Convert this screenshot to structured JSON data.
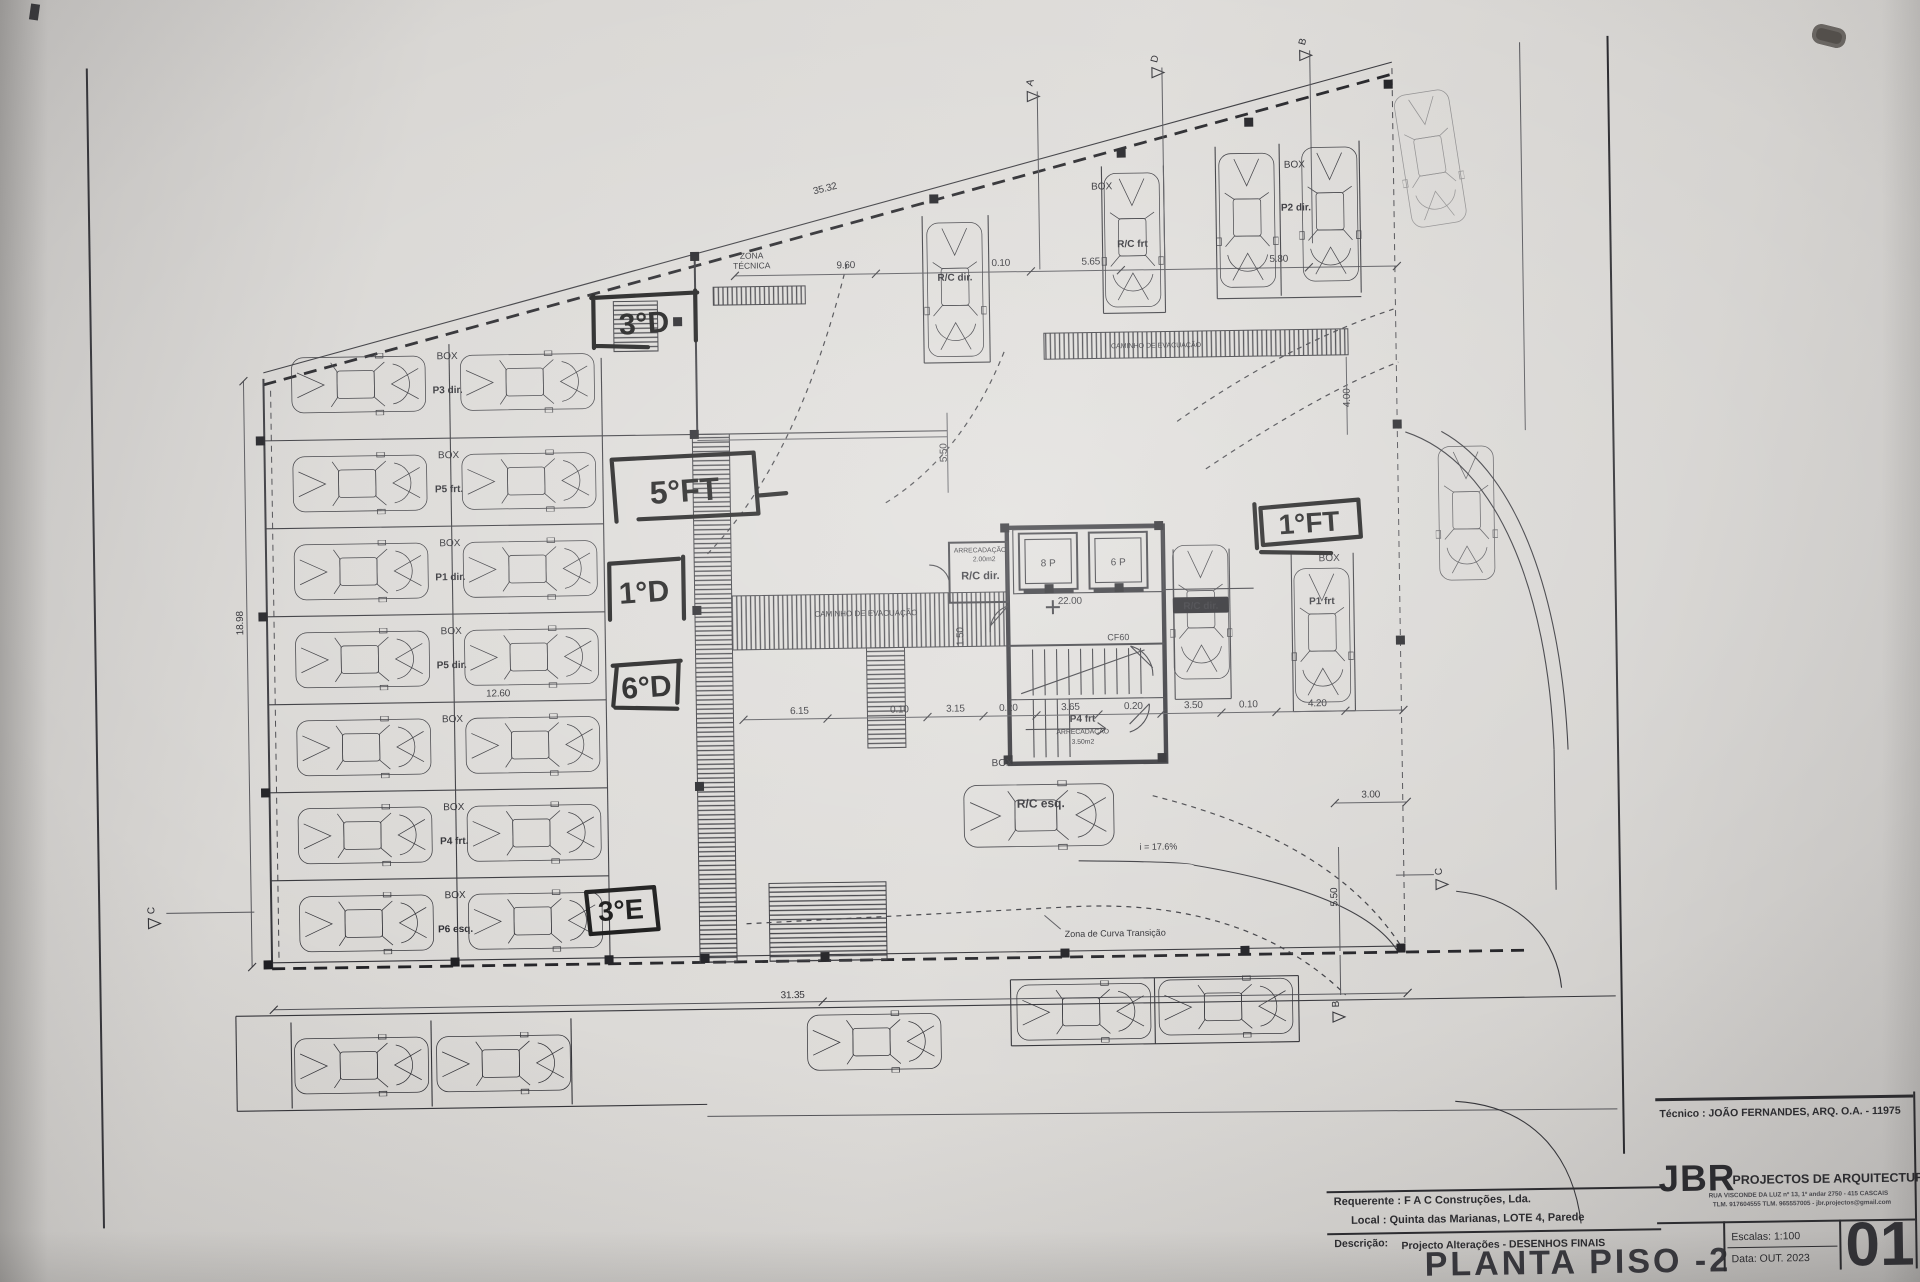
{
  "title_block": {
    "tecnico": "Técnico : JOÃO FERNANDES, ARQ.   O.A. - 11975",
    "firm": "JBR",
    "firm_tagline": "PROJECTOS DE ARQUITECTURA",
    "firm_address": "RUA VISCONDE DA LUZ nº 13, 1º andar  2750 - 415  CASCAIS",
    "firm_contacts": "TLM. 917604555  TLM. 965557005 - jbr.projectos@gmail.com",
    "requerente": "Requerente : F A C  Construções, Lda.",
    "local": "Local : Quinta das Marianas, LOTE 4, Parede",
    "descricao_label": "Descrição:",
    "descricao": "Projecto Alterações - DESENHOS FINAIS",
    "drawing_title": "PLANTA PISO -2",
    "escalas": "Escalas:  1:100",
    "data": "Data: OUT.  2023",
    "sheet_number": "01"
  },
  "handwritten_labels": [
    {
      "text": "3°D",
      "x": 649,
      "y": 328,
      "s": 30
    },
    {
      "text": "5°FT",
      "x": 687,
      "y": 497,
      "s": 32
    },
    {
      "text": "1°D",
      "x": 645,
      "y": 597,
      "s": 30
    },
    {
      "text": "6°D",
      "x": 646,
      "y": 692,
      "s": 30
    },
    {
      "text": "3°E",
      "x": 617,
      "y": 914,
      "s": 28
    },
    {
      "text": "1°FT",
      "x": 1311,
      "y": 537,
      "s": 28
    }
  ],
  "parking": {
    "box_label": "BOX",
    "rows": [
      {
        "stall": "P3 dir."
      },
      {
        "stall": "P5 frt."
      },
      {
        "stall": "P1 dir."
      },
      {
        "stall": "P5 dir."
      },
      {
        "stall": ""
      },
      {
        "stall": "P4 frt."
      },
      {
        "stall": "P6 esq."
      }
    ]
  },
  "plan_labels": [
    {
      "text": "ZONA",
      "x": 757,
      "y": 255,
      "s": 8.5
    },
    {
      "text": "TÉCNICA",
      "x": 757,
      "y": 265,
      "s": 8.5
    },
    {
      "text": "CAMINHO  DE  EVACUAÇÃO",
      "x": 866,
      "y": 614,
      "s": 8
    },
    {
      "text": "CAMINHO  DE  EVACUAÇÃO",
      "x": 1160,
      "y": 350,
      "s": 7
    },
    {
      "text": "ARRECADAÇÃO",
      "x": 981,
      "y": 552,
      "s": 6.8
    },
    {
      "text": "2.00m2",
      "x": 985,
      "y": 561,
      "s": 6.8
    },
    {
      "text": "R/C dir.",
      "x": 981,
      "y": 579,
      "s": 11,
      "b": 1
    },
    {
      "text": "8 P",
      "x": 1049,
      "y": 567,
      "s": 10
    },
    {
      "text": "6 P",
      "x": 1119,
      "y": 567,
      "s": 10
    },
    {
      "text": "CF60",
      "x": 1118,
      "y": 642,
      "s": 9
    },
    {
      "text": "P4 frt",
      "x": 1081,
      "y": 723,
      "s": 10,
      "b": 1
    },
    {
      "text": "ARRECADAÇÃO",
      "x": 1081,
      "y": 735,
      "s": 6.8
    },
    {
      "text": "3.50m2",
      "x": 1081,
      "y": 745,
      "s": 6.8
    },
    {
      "text": "BOX",
      "x": 1000,
      "y": 766,
      "s": 10
    },
    {
      "text": "R/C esq.",
      "x": 1038,
      "y": 808,
      "s": 12,
      "b": 1
    },
    {
      "text": "BOX",
      "x": 1108,
      "y": 191,
      "s": 10
    },
    {
      "text": "R/C frt",
      "x": 1138,
      "y": 249,
      "s": 10,
      "b": 1
    },
    {
      "text": "R/C dir.",
      "x": 960,
      "y": 280,
      "s": 10,
      "b": 1
    },
    {
      "text": "BOX",
      "x": 1301,
      "y": 172,
      "s": 10
    },
    {
      "text": "P2 dir.",
      "x": 1302,
      "y": 215,
      "s": 10,
      "b": 1
    },
    {
      "text": "BOX",
      "x": 1330,
      "y": 566,
      "s": 10
    },
    {
      "text": "P1 frt",
      "x": 1322,
      "y": 609,
      "s": 10,
      "b": 1
    },
    {
      "text": "R/C dir.",
      "x": 1201,
      "y": 612,
      "s": 10,
      "b": 1,
      "inv": 1
    },
    {
      "text": "Zona de Curva Transição",
      "x": 1060,
      "y": 938,
      "s": 9,
      "a": "s"
    },
    {
      "text": "i = 17.6%",
      "x": 1155,
      "y": 852,
      "s": 9
    }
  ],
  "dimensions": [
    {
      "text": "35.32",
      "x": 832,
      "y": 189,
      "r": -13
    },
    {
      "text": "9.60",
      "x": 851,
      "y": 266
    },
    {
      "text": "0.10",
      "x": 1006,
      "y": 266
    },
    {
      "text": "5.65",
      "x": 1096,
      "y": 266
    },
    {
      "text": "5.80",
      "x": 1284,
      "y": 266
    },
    {
      "text": "12.60",
      "x": 497,
      "y": 689
    },
    {
      "text": "6.15",
      "x": 798,
      "y": 711
    },
    {
      "text": "0.10",
      "x": 898,
      "y": 711
    },
    {
      "text": "3.15",
      "x": 954,
      "y": 711
    },
    {
      "text": "0.20",
      "x": 1007,
      "y": 711
    },
    {
      "text": "3.65",
      "x": 1069,
      "y": 711
    },
    {
      "text": "0.20",
      "x": 1132,
      "y": 711
    },
    {
      "text": "3.50",
      "x": 1192,
      "y": 711
    },
    {
      "text": "0.10",
      "x": 1247,
      "y": 711
    },
    {
      "text": "4.20",
      "x": 1316,
      "y": 711
    },
    {
      "text": "31.35",
      "x": 787,
      "y": 995
    },
    {
      "text": "3.00",
      "x": 1368,
      "y": 803
    },
    {
      "text": "18.98",
      "x": 243,
      "y": 612,
      "r": -90
    },
    {
      "text": "5.50",
      "x": 949,
      "y": 452,
      "r": -90
    },
    {
      "text": "5.50",
      "x": 1333,
      "y": 902,
      "r": -90
    },
    {
      "text": "4.00",
      "x": 1353,
      "y": 403,
      "r": -90
    },
    {
      "text": "1.50",
      "x": 963,
      "y": 636,
      "r": -90
    },
    {
      "text": "22.00",
      "x": 1070,
      "y": 605
    }
  ],
  "section_markers": [
    {
      "letter": "A",
      "x": 1041,
      "y": 84,
      "r": -75
    },
    {
      "letter": "D",
      "x": 1166,
      "y": 62,
      "r": -75
    },
    {
      "letter": "B",
      "x": 1314,
      "y": 47,
      "r": -75
    },
    {
      "letter": "C",
      "x": 150,
      "y": 898,
      "r": -90
    },
    {
      "letter": "C",
      "x": 1438,
      "y": 878,
      "r": -90
    },
    {
      "letter": "B",
      "x": 1333,
      "y": 1009,
      "r": -90
    }
  ]
}
